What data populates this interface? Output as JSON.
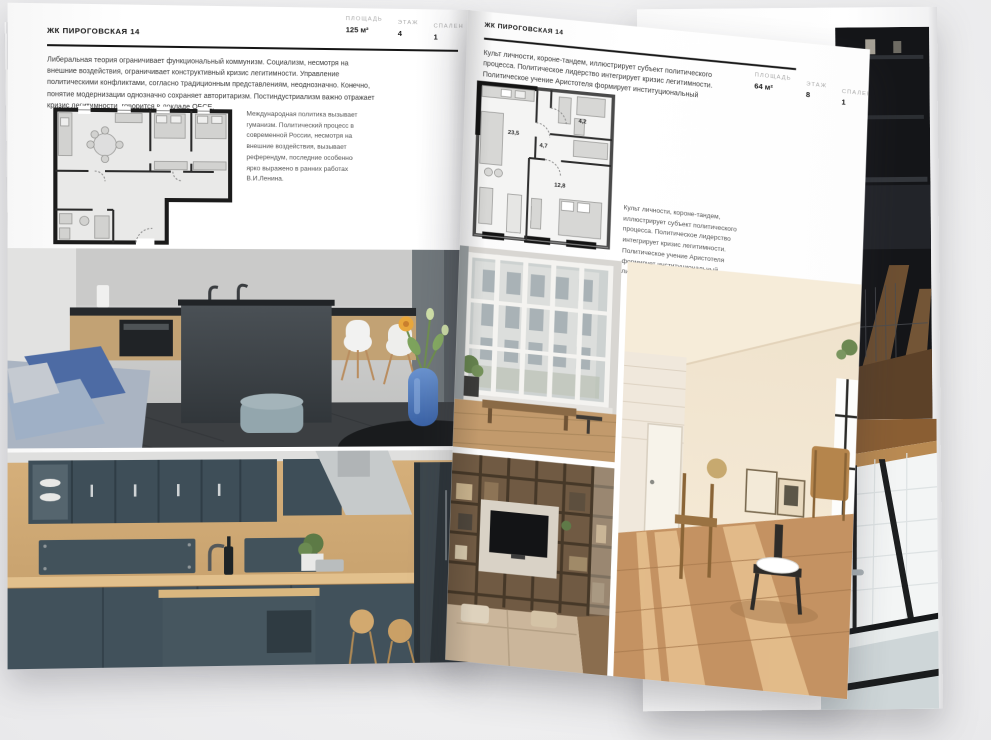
{
  "colors": {
    "backdrop": "#efeff0",
    "page": "#ffffff",
    "ink": "#1c1c1c",
    "muted_label": "#aaaaaa",
    "rule": "#161616"
  },
  "left_page": {
    "header": "ЖК ПИРОГОВСКАЯ 14",
    "stats": [
      {
        "label": "ПЛОЩАДЬ",
        "value": "125 м²"
      },
      {
        "label": "ЭТАЖ",
        "value": "4"
      },
      {
        "label": "СПАЛЕН",
        "value": "1"
      }
    ],
    "paragraph": "Либеральная теория ограничивает функциональный коммунизм. Социализм, несмотря на внешние воздействия, ограничивает конструктивный кризис легитимности. Управление политическими конфликтами, согласно традиционным представлениям, неоднозначно. Конечно, понятие модернизации однозначно сохраняет авторитаризм. Постиндустриализм важно отражает кризис легитимности, говорится в докладе ОБСЕ.",
    "note": "Международная политика вызывает гуманизм. Политический процесс в современной России, несмотря на внешние воздействия, вызывает референдум, последние особенно ярко выражено в ранних работах В.И.Ленина."
  },
  "right_page": {
    "header": "ЖК ПИРОГОВСКАЯ 14",
    "paragraph": "Культ личности, короне-тандем, иллюстрирует субъект политического процесса. Политическое лидерство интегрирует кризис легитимности. Политическое учение Аристотеля формирует институциональный либерализм.",
    "stats": [
      {
        "label": "ПЛОЩАДЬ",
        "value": "64 м²"
      },
      {
        "label": "ЭТАЖ",
        "value": "8"
      },
      {
        "label": "СПАЛЕН",
        "value": "1"
      }
    ],
    "note": "Культ личности, короне-тандем, иллюстрирует субъект политического процесса. Политическое лидерство интегрирует кризис легитимности. Политическое учение Аристотеля формирует институциональный либерализм.",
    "plan_rooms": [
      "23,5",
      "4,7",
      "4,2",
      "12,8"
    ]
  }
}
